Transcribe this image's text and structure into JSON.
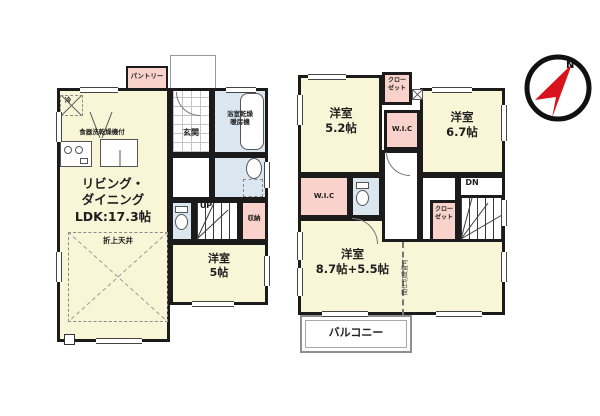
{
  "floor1": {
    "pantry_label": "パントリー",
    "fridge_label": "冷",
    "dishwasher_label": "食器洗乾燥機付",
    "entrance_label": "玄関",
    "bathroom_label": "浴室乾燥\n暖房機",
    "stairs_label": "UP",
    "storage_label": "収納",
    "living_label": "リビング・\nダイニング\nLDK:17.3帖",
    "ceiling_label": "折上天井",
    "room5_label": "洋室\n5帖"
  },
  "floor2": {
    "room52_label": "洋室\n5.2帖",
    "closet_top_label": "クロー\nゼット",
    "wic_top_label": "W.I.C",
    "room67_label": "洋室\n6.7帖",
    "wic_left_label": "W.I.C",
    "stairs_label": "DN",
    "closet_bottom_label": "クロー\nゼット",
    "room_main_label": "洋室\n8.7帖+5.5帖",
    "partition_label": "間仕切設置可",
    "balcony_label": "バルコニー"
  },
  "compass": {
    "north_label": "N"
  },
  "colors": {
    "room_fill": "#f9f6d8",
    "closet_fill": "#f8d2cb",
    "sanitary_fill": "#dae7f1",
    "wall": "#1b1b1b",
    "compass_red": "#d8131c"
  }
}
